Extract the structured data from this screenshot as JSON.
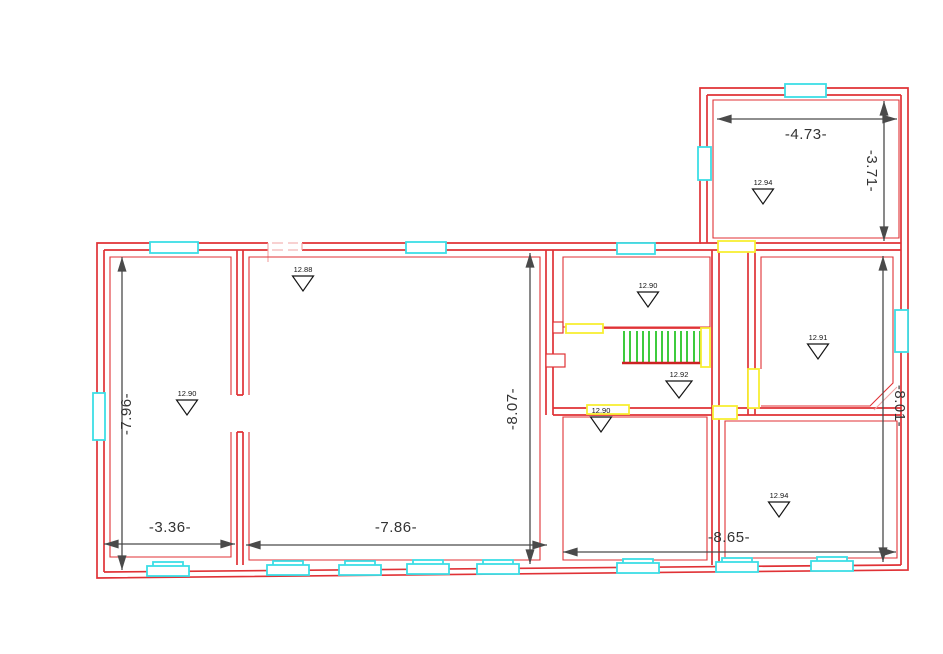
{
  "colors": {
    "wall_red": "#e03236",
    "wall_light": "#f2a3a3",
    "window_cyan": "#3cdee6",
    "door_yellow": "#f7ee33",
    "stair_green": "#3ecb3e",
    "stair_red": "#cc2222",
    "dim_gray": "#4a4a4a",
    "label_dark": "#333333",
    "marker_black": "#141414",
    "background": "#ffffff"
  },
  "dimensions": {
    "top_right_room_width": "-4.73-",
    "top_right_room_depth": "-3.71-",
    "left_wing_depth": "-7.96-",
    "main_room_depth": "-8.07-",
    "right_wing_depth": "-8.01-",
    "left_room_width": "-3.36-",
    "main_room_width": "-7.86-",
    "bottom_right_width": "-8.65-"
  },
  "elevations": {
    "top_right_room": "12.94",
    "main_room": "12.88",
    "left_room": "12.90",
    "middle_hall": "12.90",
    "stair_landing": "12.92",
    "bottom_middle_room": "12.90",
    "right_middle_room": "12.91",
    "bottom_right_room": "12.94"
  }
}
